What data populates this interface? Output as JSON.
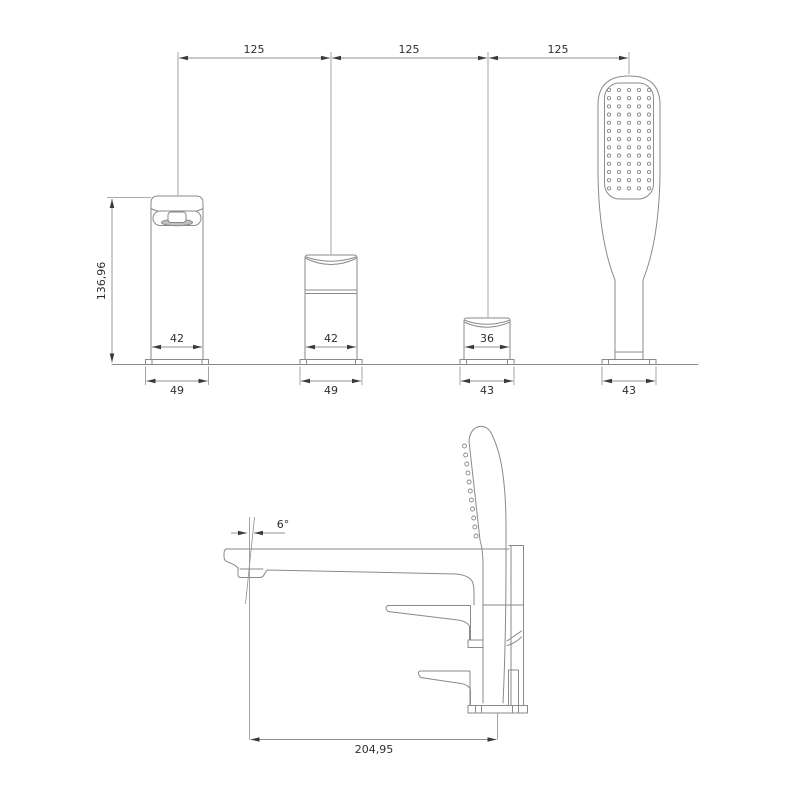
{
  "drawing": {
    "front_view": {
      "spacing_dims": {
        "span1": "125",
        "span2": "125",
        "span3": "125"
      },
      "height_dim": "136,96",
      "body_width_dims": {
        "w1": "42",
        "w2": "42",
        "w3": "36"
      },
      "base_width_dims": {
        "b1": "49",
        "b2": "49",
        "b3": "43",
        "b4": "43"
      }
    },
    "side_view": {
      "angle_dim": "6°",
      "length_dim": "204,95"
    }
  },
  "colors": {
    "line": "#8a8a8a",
    "dim_line": "#8f8f8f",
    "arrow": "#3a3a3a",
    "text": "#2e2e2e",
    "background": "#ffffff"
  }
}
